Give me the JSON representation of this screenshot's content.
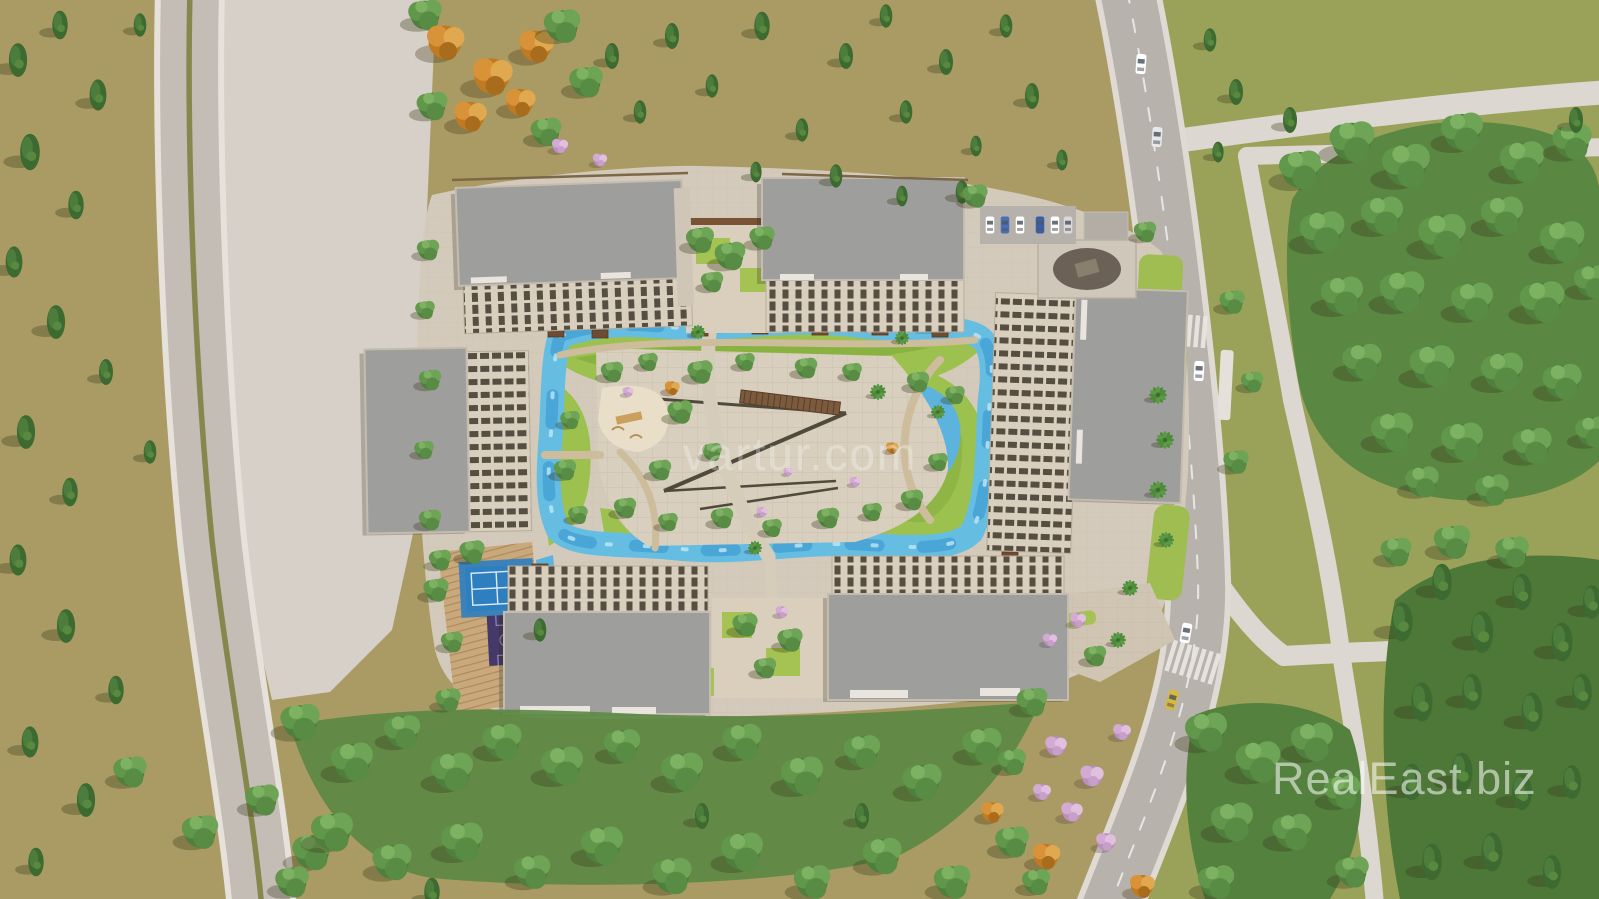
{
  "image": {
    "kind": "aerial-3d-architectural-render",
    "description": "Top-down bird's-eye 3D rendering of a residential complex with landscaped courtyard pools, sport courts, internal roads and surrounding woodland",
    "width_px": 1599,
    "height_px": 899
  },
  "watermarks": {
    "center": "vartur.com",
    "bottom_right": "RealEast.biz"
  },
  "scene": {
    "buildings_count": 7,
    "features": [
      "apartment-blocks",
      "courtyard-pool-loop",
      "kidney-pond",
      "tennis-court",
      "basketball-court",
      "playground",
      "central-plaza-pergolas",
      "surface-parking",
      "street-with-crosswalks",
      "tree-park"
    ]
  },
  "palette": {
    "ground_khaki": "#a99b63",
    "grass_olive": "#9aa25a",
    "lawn_green": "#9cc14e",
    "tree_green": "#4e7f3c",
    "tree_autumn_orange": "#cd8a30",
    "tree_blossom_pink": "#cfa3cf",
    "pavement_light": "#d6d0c8",
    "asphalt_gray": "#bab4ad",
    "roof_gray": "#9e9e9c",
    "facade_beige": "#d8cfbf",
    "pool_blue": "#62b9e2",
    "tennis_blue": "#2e7fc0",
    "court_purple": "#463a6e",
    "deck_wood": "#c9a87c"
  }
}
